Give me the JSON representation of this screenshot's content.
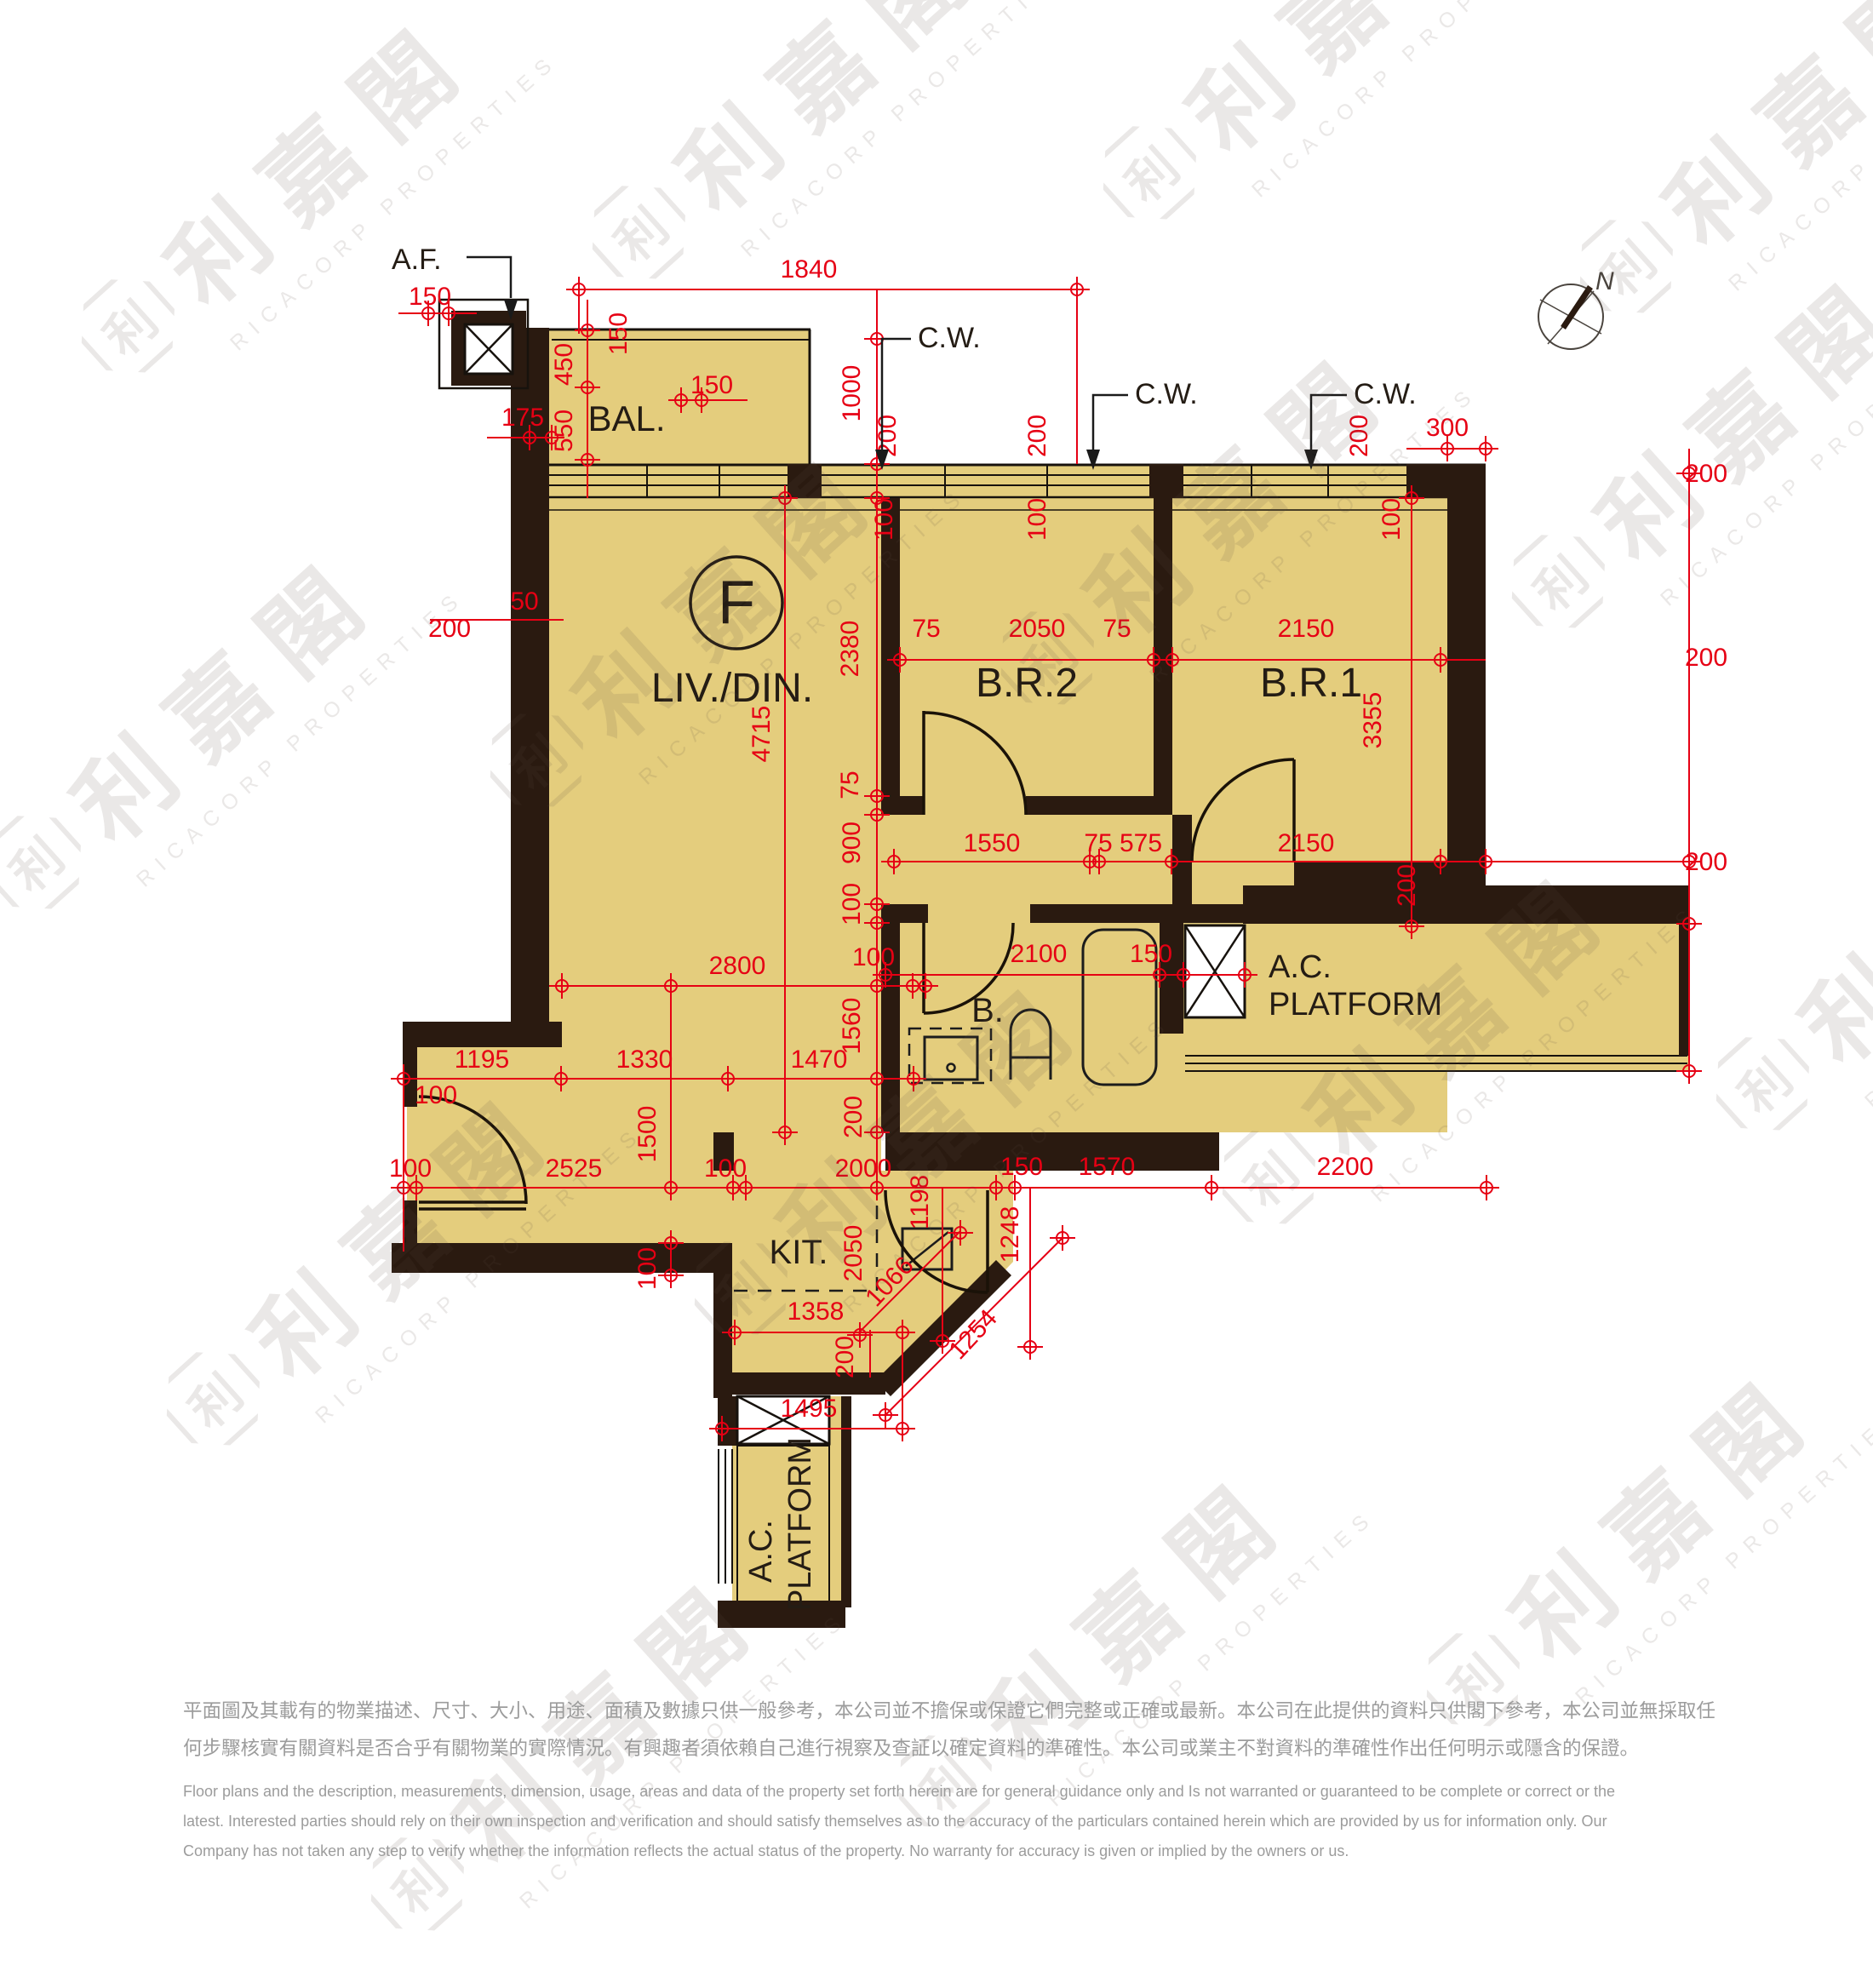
{
  "watermark": {
    "logo": "利",
    "cn": "利嘉閣",
    "en": "RICACORP PROPERTIES"
  },
  "compass": {
    "north": "N"
  },
  "labels": {
    "af": "A.F.",
    "cw": "C.W.",
    "bal": "BAL.",
    "flat": "F",
    "livdin": "LIV./DIN.",
    "br2": "B.R.2",
    "br1": "B.R.1",
    "bath": "B.",
    "kit": "KIT.",
    "ac": "A.C.",
    "platform": "PLATFORM"
  },
  "dims": [
    {
      "v": "150"
    },
    {
      "v": "1840"
    },
    {
      "v": "175"
    },
    {
      "v": "450"
    },
    {
      "v": "550"
    },
    {
      "v": "150"
    },
    {
      "v": "150"
    },
    {
      "v": "1000"
    },
    {
      "v": "200"
    },
    {
      "v": "100"
    },
    {
      "v": "200"
    },
    {
      "v": "100"
    },
    {
      "v": "200"
    },
    {
      "v": "100"
    },
    {
      "v": "300"
    },
    {
      "v": "200"
    },
    {
      "v": "50"
    },
    {
      "v": "200"
    },
    {
      "v": "2380"
    },
    {
      "v": "75"
    },
    {
      "v": "2050"
    },
    {
      "v": "75"
    },
    {
      "v": "2150"
    },
    {
      "v": "3355"
    },
    {
      "v": "200"
    },
    {
      "v": "1550"
    },
    {
      "v": "75"
    },
    {
      "v": "575"
    },
    {
      "v": "2150"
    },
    {
      "v": "200"
    },
    {
      "v": "200"
    },
    {
      "v": "75"
    },
    {
      "v": "900"
    },
    {
      "v": "100"
    },
    {
      "v": "4715"
    },
    {
      "v": "2800"
    },
    {
      "v": "100"
    },
    {
      "v": "1560"
    },
    {
      "v": "200"
    },
    {
      "v": "2100"
    },
    {
      "v": "150"
    },
    {
      "v": "1195"
    },
    {
      "v": "1330"
    },
    {
      "v": "1470"
    },
    {
      "v": "100"
    },
    {
      "v": "1500"
    },
    {
      "v": "100"
    },
    {
      "v": "2525"
    },
    {
      "v": "100"
    },
    {
      "v": "2000"
    },
    {
      "v": "1198"
    },
    {
      "v": "150"
    },
    {
      "v": "1570"
    },
    {
      "v": "2200"
    },
    {
      "v": "1248"
    },
    {
      "v": "2050"
    },
    {
      "v": "1066"
    },
    {
      "v": "1254"
    },
    {
      "v": "1358"
    },
    {
      "v": "200"
    },
    {
      "v": "1495"
    },
    {
      "v": "100"
    }
  ],
  "disclaimer": {
    "cn1": "平面圖及其載有的物業描述、尺寸、大小、用途、面積及數據只供一般參考，本公司並不擔保或保證它們完整或正確或最新。本公司在此提供的資料只供閣下參考，本公司並無採取任",
    "cn2": "何步驟核實有關資料是否合乎有關物業的實際情況。有興趣者須依賴自己進行視察及查証以確定資料的準確性。本公司或業主不對資料的準確性作出任何明示或隱含的保證。",
    "en1": "Floor plans and the description, measurements, dimension, usage, areas and data of the property set forth herein are for general guidance only and Is not warranted or guaranteed to be complete or correct or the",
    "en2": "latest. Interested parties should rely on their own inspection and verification and should satisfy themselves as to the accuracy of the particulars contained herein which are provided by us for information only.  Our",
    "en3": "Company has not taken any step to verify whether the information reflects the actual status of the property.  No warranty for accuracy is given or implied by the owners or us."
  }
}
